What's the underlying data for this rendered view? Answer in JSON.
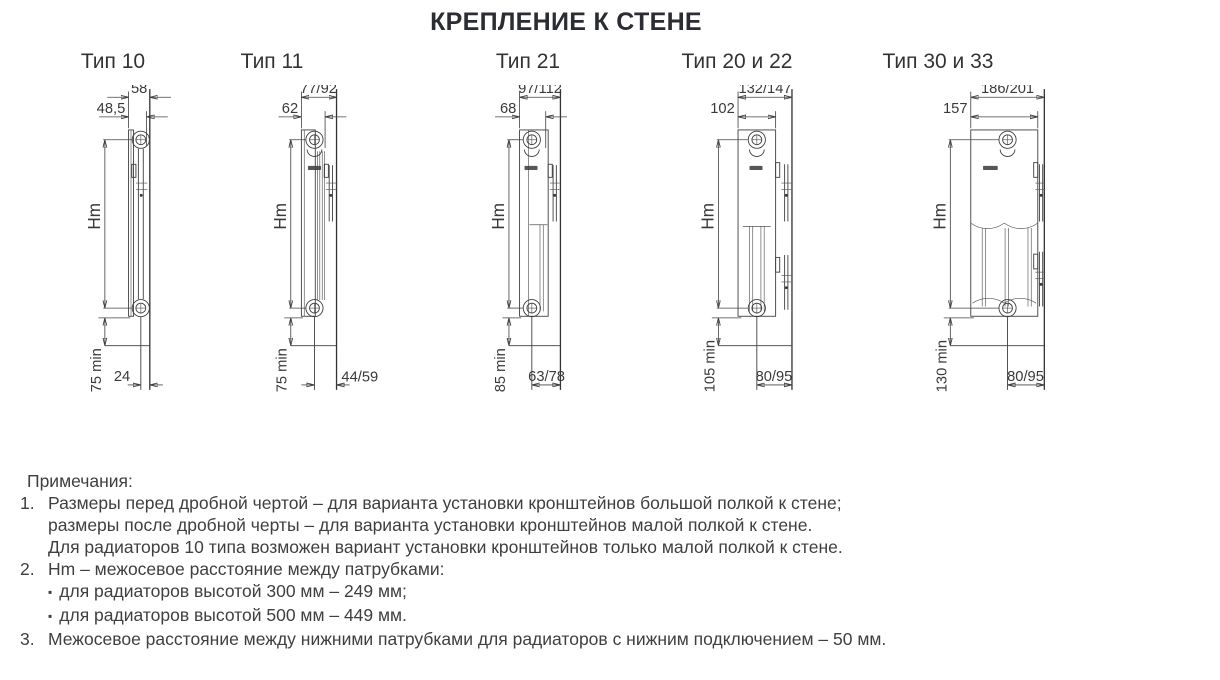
{
  "page_title": "КРЕПЛЕНИЕ К СТЕНЕ",
  "diagrams": [
    {
      "title": "Тип 10",
      "depth_to_wall": "58",
      "bracket_depth": "48,5",
      "axis_label": "Hm",
      "floor_clearance": "75 min",
      "pipe_to_wall": "24"
    },
    {
      "title": "Тип 11",
      "depth_to_wall": "77/92",
      "bracket_depth": "62",
      "axis_label": "Hm",
      "floor_clearance": "75 min",
      "pipe_to_wall": "44/59"
    },
    {
      "title": "Тип 21",
      "depth_to_wall": "97/112",
      "bracket_depth": "68",
      "axis_label": "Hm",
      "floor_clearance": "85 min",
      "pipe_to_wall": "63/78"
    },
    {
      "title": "Тип 20 и 22",
      "depth_to_wall": "132/147",
      "bracket_depth": "102",
      "axis_label": "Hm",
      "floor_clearance": "105 min",
      "pipe_to_wall": "80/95"
    },
    {
      "title": "Тип 30 и 33",
      "depth_to_wall": "186/201",
      "bracket_depth": "157",
      "axis_label": "Hm",
      "floor_clearance": "130 min",
      "pipe_to_wall": "80/95"
    }
  ],
  "notes": {
    "header": "Примечания:",
    "item1_num": "1.",
    "item1_line1": "Размеры перед дробной чертой – для варианта установки кронштейнов большой полкой к стене;",
    "item1_line2": "размеры после дробной черты – для варианта установки кронштейнов малой полкой к стене.",
    "item1_line3": "Для радиаторов 10 типа возможен вариант установки кронштейнов только малой полкой к стене.",
    "item2_num": "2.",
    "item2_line1": "Hm – межосевое расстояние между патрубками:",
    "item2_bullet": "▪",
    "item2_b1": "для радиаторов высотой 300 мм – 249 мм;",
    "item2_b2": "для радиаторов высотой 500 мм – 449 мм.",
    "item3_num": "3.",
    "item3_line1": "Межосевое расстояние между нижними патрубками для радиаторов с нижним подключением – 50 мм."
  },
  "colors": {
    "line": "#3f3f3f",
    "text": "#3a3a3a",
    "title": "#2b2d33"
  }
}
